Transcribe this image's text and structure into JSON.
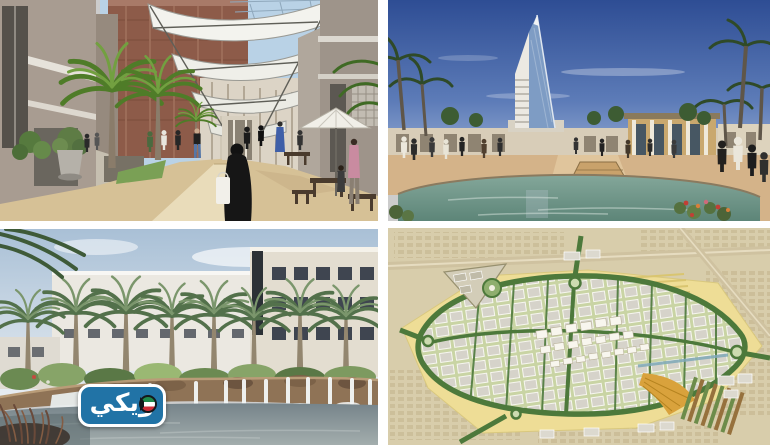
{
  "collage": {
    "gutter_color": "#ffffff",
    "panels": [
      {
        "name": "promenade-rendering",
        "description": "Architectural rendering of a covered retail promenade with white fabric canopy, palm trees, cafe umbrella and pedestrians"
      },
      {
        "name": "tower-plaza-rendering",
        "description": "Architectural rendering of a sail-shaped landmark tower over a palm-lined plaza with a large reflecting pool under a deep blue sky"
      },
      {
        "name": "waterfall-lake-rendering",
        "description": "Architectural rendering of a rock waterfall and lake fringed by a row of palm trees in front of low white buildings"
      },
      {
        "name": "master-plan-map",
        "description": "Aerial master plan map of a new urban development with a green loop road, grey building blocks and sandy desert surroundings"
      }
    ]
  },
  "watermark": {
    "text": "ويكي",
    "badge_bg": "#2173a6",
    "badge_border": "#ffffff",
    "flag_green": "#1f8a4c",
    "flag_white": "#ffffff",
    "flag_red": "#ce2b37",
    "flag_black": "#15181c"
  }
}
